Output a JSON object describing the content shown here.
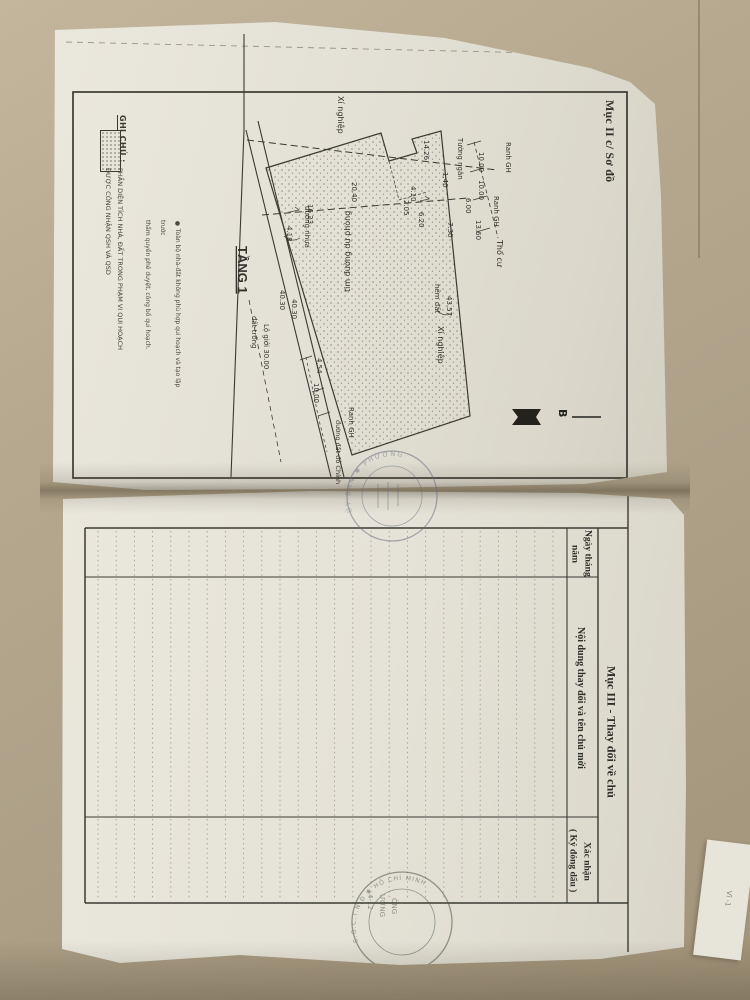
{
  "doc": {
    "page1": {
      "section_title": "Mục II c/ Sơ đồ",
      "plan": {
        "floor_label": "TẦNG 1",
        "north_label": "B",
        "labels": {
          "planned_road": "tim đường dự phòng",
          "partition_wall": "Tường ngăn",
          "boundary": "Ranh GH",
          "residential": "Thổ cư",
          "factory": "Xí nghiệp",
          "asphalt_road": "đường nhựa",
          "dirt_alley": "hẻm đất",
          "vacant_land": "đất trống",
          "road_boundary": "Lộ giới 30.00",
          "street_note": "đường đất đỏ Chính"
        },
        "dimensions": [
          "14.26",
          "20.40",
          "16.23",
          "4.18",
          "40.30",
          "40.30",
          "43.57",
          "4.54",
          "10.00",
          "10.00",
          "10.00",
          "6.00",
          "13.60",
          "7.30",
          "6.20",
          "4.10",
          "2.05",
          "1.40"
        ]
      },
      "note": {
        "line1": "● Toàn bộ nhà-đất không phù hợp qui hoạch và tạo lập trước",
        "line2": "thẩm quyền phê duyệt, công bố qui hoạch."
      },
      "legend": {
        "title": "GHI CHÚ :",
        "caption_line1": "PHẦN DIỆN TÍCH NHÀ, ĐẤT TRONG PHẠM VI QUI HOẠCH",
        "caption_line2": "ĐƯỢC CÔNG NHẬN QSH VÀ QSD"
      }
    },
    "page2": {
      "section_title": "Mục III - Thay đổi về chủ",
      "table": {
        "col_date_line1": "Ngày tháng",
        "col_date_line2": "năm",
        "col_content": "Nội dung thay đổi và tên chủ mới",
        "col_confirm_line1": "Xác nhận",
        "col_confirm_line2": "( Ký đóng dấu )"
      }
    },
    "stamps": {
      "fold_stamp_rim": "ỦY BAN ✱ PHƯỜNG",
      "bottom_stamp_rim": "S.G.C.T.N.Đ ✱ HỒ CHÍ MINH",
      "bottom_stamp_line1": "ƯỞNG",
      "bottom_stamp_line2": "ÒNG",
      "bottom_stamp_line3": "4-12",
      "corner_note": "Vĩ -1"
    },
    "colors": {
      "table_surface": "#b7a98f",
      "paper": "#e8e5db",
      "ink": "#3b3a32",
      "stamp_blue": "#60667a",
      "stamp_green": "#4d5347"
    }
  }
}
